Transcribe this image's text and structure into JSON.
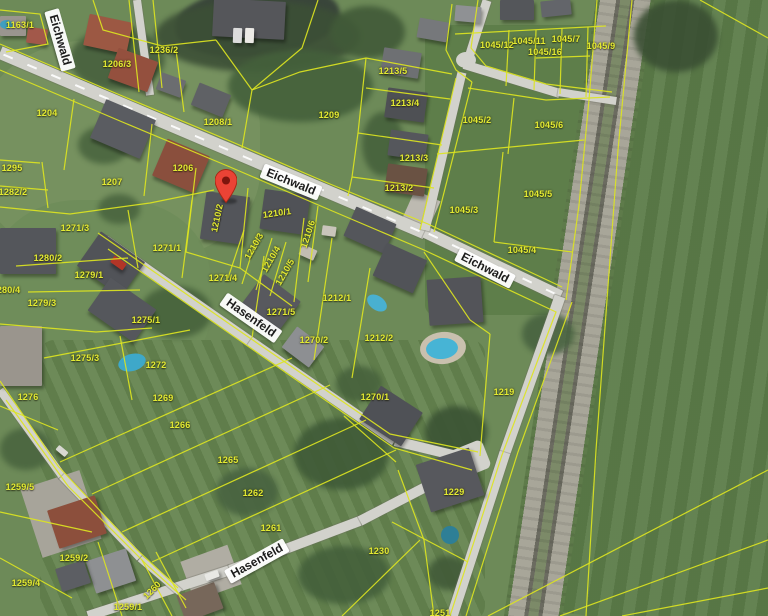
{
  "map_type": "satellite-cadastral-view",
  "marker": {
    "label": "selected-location",
    "color": "#ea4335",
    "x": 226,
    "y": 203
  },
  "street_signs": [
    {
      "text": "Eichwald",
      "x": 60,
      "y": 40,
      "rot": 74
    },
    {
      "text": "Eichwald",
      "x": 291,
      "y": 182,
      "rot": 22
    },
    {
      "text": "Eichwald",
      "x": 485,
      "y": 268,
      "rot": 27
    },
    {
      "text": "Hasenfeld",
      "x": 251,
      "y": 318,
      "rot": 35
    },
    {
      "text": "Hasenfeld",
      "x": 257,
      "y": 561,
      "rot": -29
    }
  ],
  "parcel_labels": [
    {
      "text": "1163/1",
      "x": 20,
      "y": 25
    },
    {
      "text": "1236/2",
      "x": 164,
      "y": 50
    },
    {
      "text": "1206/3",
      "x": 117,
      "y": 64
    },
    {
      "text": "1204",
      "x": 47,
      "y": 113
    },
    {
      "text": "1208/1",
      "x": 218,
      "y": 122
    },
    {
      "text": "1209",
      "x": 329,
      "y": 115
    },
    {
      "text": "1206",
      "x": 183,
      "y": 168
    },
    {
      "text": "1207",
      "x": 112,
      "y": 182
    },
    {
      "text": "1295",
      "x": 12,
      "y": 168
    },
    {
      "text": "1282/2",
      "x": 13,
      "y": 192
    },
    {
      "text": "1213/5",
      "x": 393,
      "y": 71
    },
    {
      "text": "1213/4",
      "x": 405,
      "y": 103
    },
    {
      "text": "1213/3",
      "x": 414,
      "y": 158
    },
    {
      "text": "1213/2",
      "x": 399,
      "y": 188
    },
    {
      "text": "1045/12",
      "x": 497,
      "y": 45
    },
    {
      "text": "1045/11",
      "x": 529,
      "y": 41
    },
    {
      "text": "1045/7",
      "x": 566,
      "y": 39
    },
    {
      "text": "1045/16",
      "x": 545,
      "y": 52
    },
    {
      "text": "1045/9",
      "x": 601,
      "y": 46
    },
    {
      "text": "1045/2",
      "x": 477,
      "y": 120
    },
    {
      "text": "1045/6",
      "x": 549,
      "y": 125
    },
    {
      "text": "1045/3",
      "x": 464,
      "y": 210
    },
    {
      "text": "1045/5",
      "x": 538,
      "y": 194
    },
    {
      "text": "1045/4",
      "x": 522,
      "y": 250
    },
    {
      "text": "1271/3",
      "x": 75,
      "y": 228
    },
    {
      "text": "1280/2",
      "x": 48,
      "y": 258
    },
    {
      "text": "1271/1",
      "x": 167,
      "y": 248
    },
    {
      "text": "1279/1",
      "x": 89,
      "y": 275
    },
    {
      "text": "1280/4",
      "x": 6,
      "y": 290
    },
    {
      "text": "1279/3",
      "x": 42,
      "y": 303
    },
    {
      "text": "1275/1",
      "x": 146,
      "y": 320
    },
    {
      "text": "1275/3",
      "x": 85,
      "y": 358
    },
    {
      "text": "1272",
      "x": 156,
      "y": 365
    },
    {
      "text": "1276",
      "x": 28,
      "y": 397
    },
    {
      "text": "1271/4",
      "x": 223,
      "y": 278
    },
    {
      "text": "1271/5",
      "x": 281,
      "y": 312
    },
    {
      "text": "1210/2",
      "x": 217,
      "y": 218,
      "rot": -78
    },
    {
      "text": "1210/1",
      "x": 277,
      "y": 213,
      "rot": -8
    },
    {
      "text": "1210/3",
      "x": 254,
      "y": 246,
      "rot": -60
    },
    {
      "text": "1210/4",
      "x": 271,
      "y": 259,
      "rot": -60
    },
    {
      "text": "1210/5",
      "x": 285,
      "y": 272,
      "rot": -60
    },
    {
      "text": "1210/6",
      "x": 308,
      "y": 234,
      "rot": -72
    },
    {
      "text": "1212/1",
      "x": 337,
      "y": 298
    },
    {
      "text": "1270/2",
      "x": 314,
      "y": 340
    },
    {
      "text": "1212/2",
      "x": 379,
      "y": 338
    },
    {
      "text": "1270/1",
      "x": 375,
      "y": 397
    },
    {
      "text": "1219",
      "x": 504,
      "y": 392
    },
    {
      "text": "1229",
      "x": 454,
      "y": 492
    },
    {
      "text": "1269",
      "x": 163,
      "y": 398
    },
    {
      "text": "1266",
      "x": 180,
      "y": 425
    },
    {
      "text": "1265",
      "x": 228,
      "y": 460
    },
    {
      "text": "1262",
      "x": 253,
      "y": 493
    },
    {
      "text": "1261",
      "x": 271,
      "y": 528
    },
    {
      "text": "1230",
      "x": 379,
      "y": 551
    },
    {
      "text": "1251",
      "x": 440,
      "y": 613
    },
    {
      "text": "1259/5",
      "x": 20,
      "y": 487
    },
    {
      "text": "1259/2",
      "x": 74,
      "y": 558
    },
    {
      "text": "1259/4",
      "x": 26,
      "y": 583
    },
    {
      "text": "1259/1",
      "x": 128,
      "y": 607
    },
    {
      "text": "1260",
      "x": 152,
      "y": 590,
      "rot": -45
    }
  ],
  "colors": {
    "parcel_line": "#dce421",
    "parcel_text": "#e3ea33",
    "road": "#d2d2cc",
    "sign_background": "#ffffff",
    "sign_text": "#1b1b1b",
    "marker": "#ea4335"
  }
}
